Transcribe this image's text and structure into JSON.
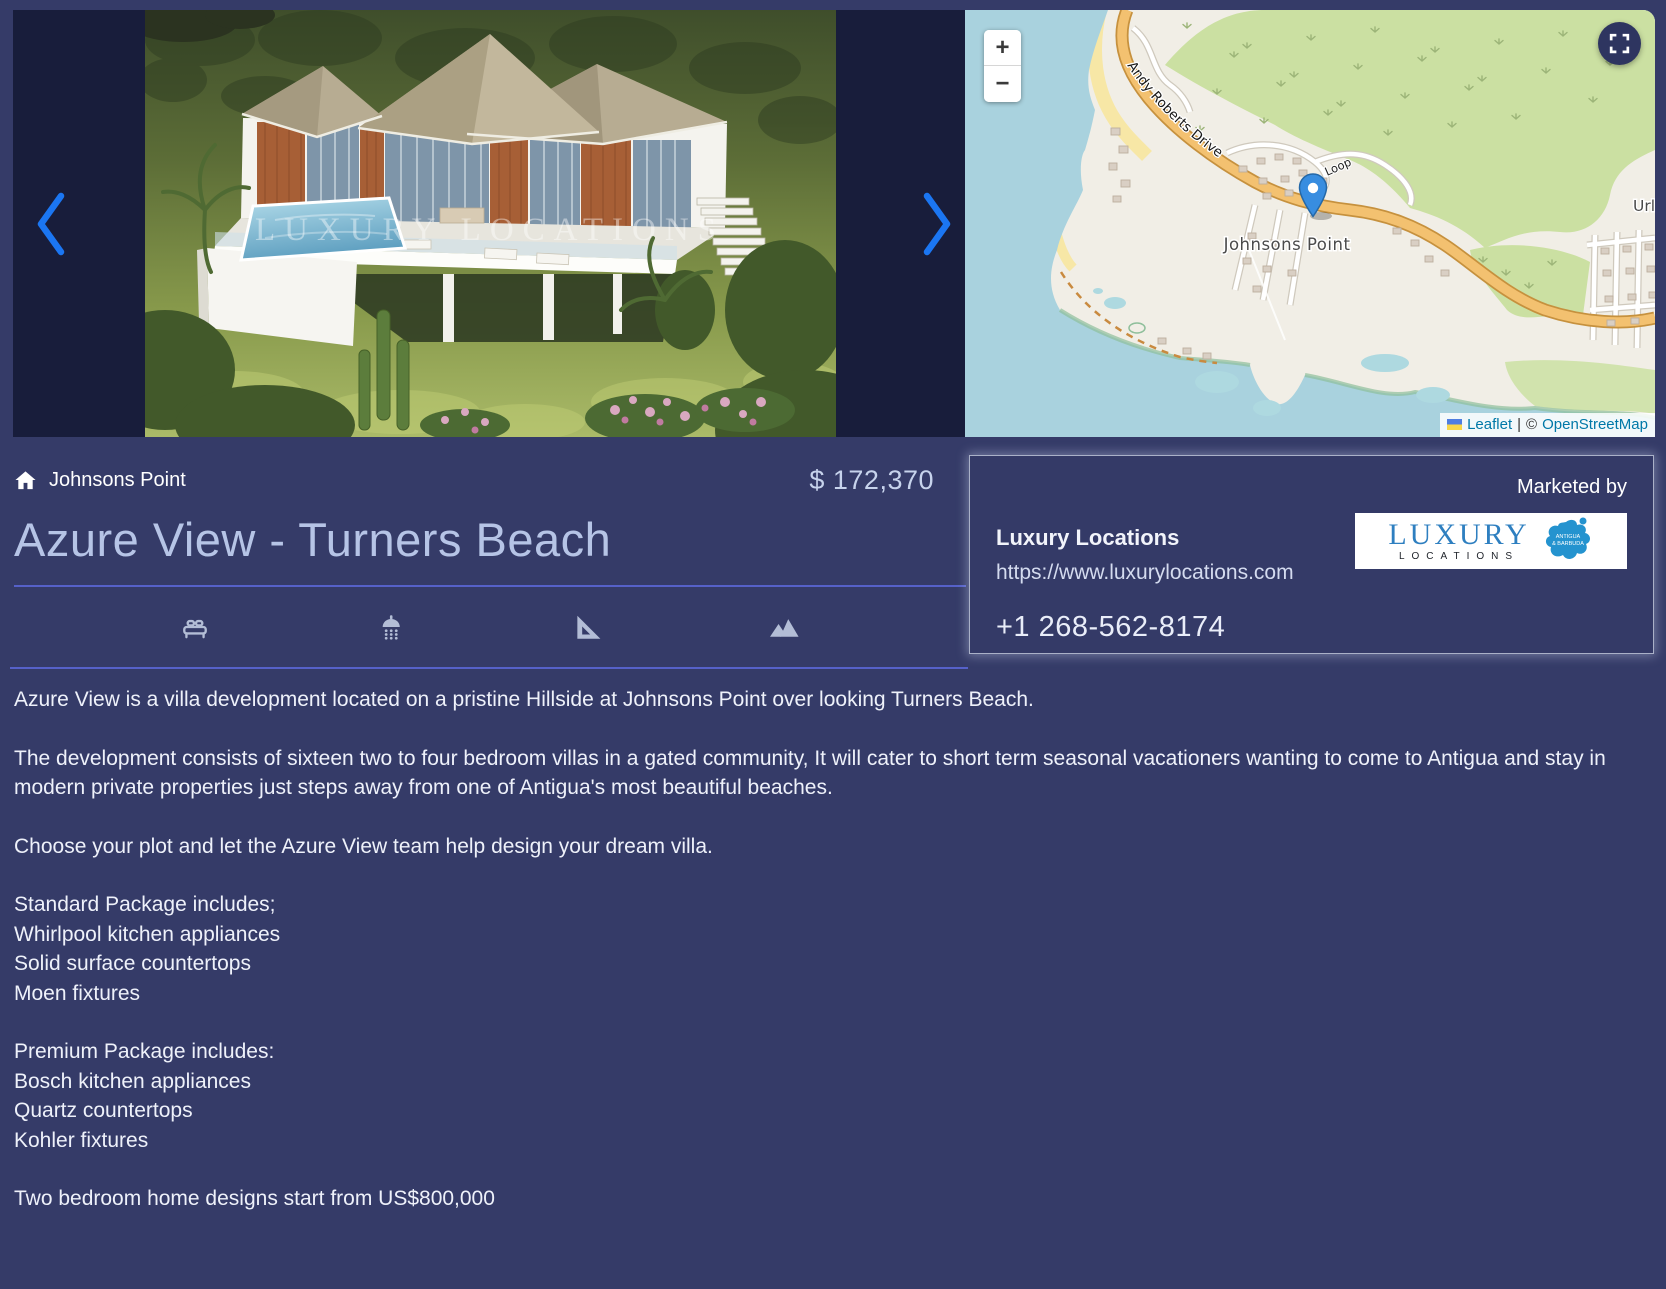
{
  "hero": {
    "watermark": "LUXURY LOCATIONS",
    "map": {
      "zoom_in_label": "+",
      "zoom_out_label": "−",
      "road_label": "Andy Roberts Drive",
      "loop_label": "Loop",
      "place_label": "Johnsons Point",
      "place_label_right": "Urlin",
      "attribution": {
        "leaflet": "Leaflet",
        "divider": "|",
        "copyright": "©",
        "osm": "OpenStreetMap"
      }
    }
  },
  "listing": {
    "breadcrumb": "Johnsons Point",
    "price": "$ 172,370",
    "title": "Azure View - Turners Beach",
    "features": [
      {
        "icon": "bed-icon"
      },
      {
        "icon": "shower-icon"
      },
      {
        "icon": "area-icon"
      },
      {
        "icon": "view-icon"
      }
    ]
  },
  "agent_card": {
    "marketed_by_label": "Marketed by",
    "agency_name": "Luxury Locations",
    "website": "https://www.luxurylocations.com",
    "phone": "+1 268-562-8174",
    "logo": {
      "word1": "LUXURY",
      "word2": "LOCATIONS",
      "badge_line1": "ANTIGUA",
      "badge_line2": "& BARBUDA"
    }
  },
  "description": {
    "paragraphs": [
      "Azure View is a villa development located on a pristine Hillside at Johnsons Point over looking Turners Beach.",
      "The development consists of sixteen two to four bedroom villas in a gated community, It will cater to short term seasonal vacationers wanting to come to Antigua and stay in modern private properties just steps away from one of Antigua's most beautiful beaches.",
      "Choose your plot and let the Azure View team help design your dream villa.",
      "Standard Package includes;\nWhirlpool kitchen appliances\nSolid surface countertops\nMoen fixtures",
      "Premium Package includes:\nBosch kitchen appliances\nQuartz countertops\nKohler fixtures",
      "Two bedroom home designs start from US$800,000"
    ]
  },
  "colors": {
    "page_bg": "#353b68",
    "hero_bg": "#181d3b",
    "chevron_blue": "#1b76f2",
    "divider_blue": "#5661c9",
    "map_link_blue": "#0078a8",
    "logo_blue": "#2e7fc0"
  }
}
